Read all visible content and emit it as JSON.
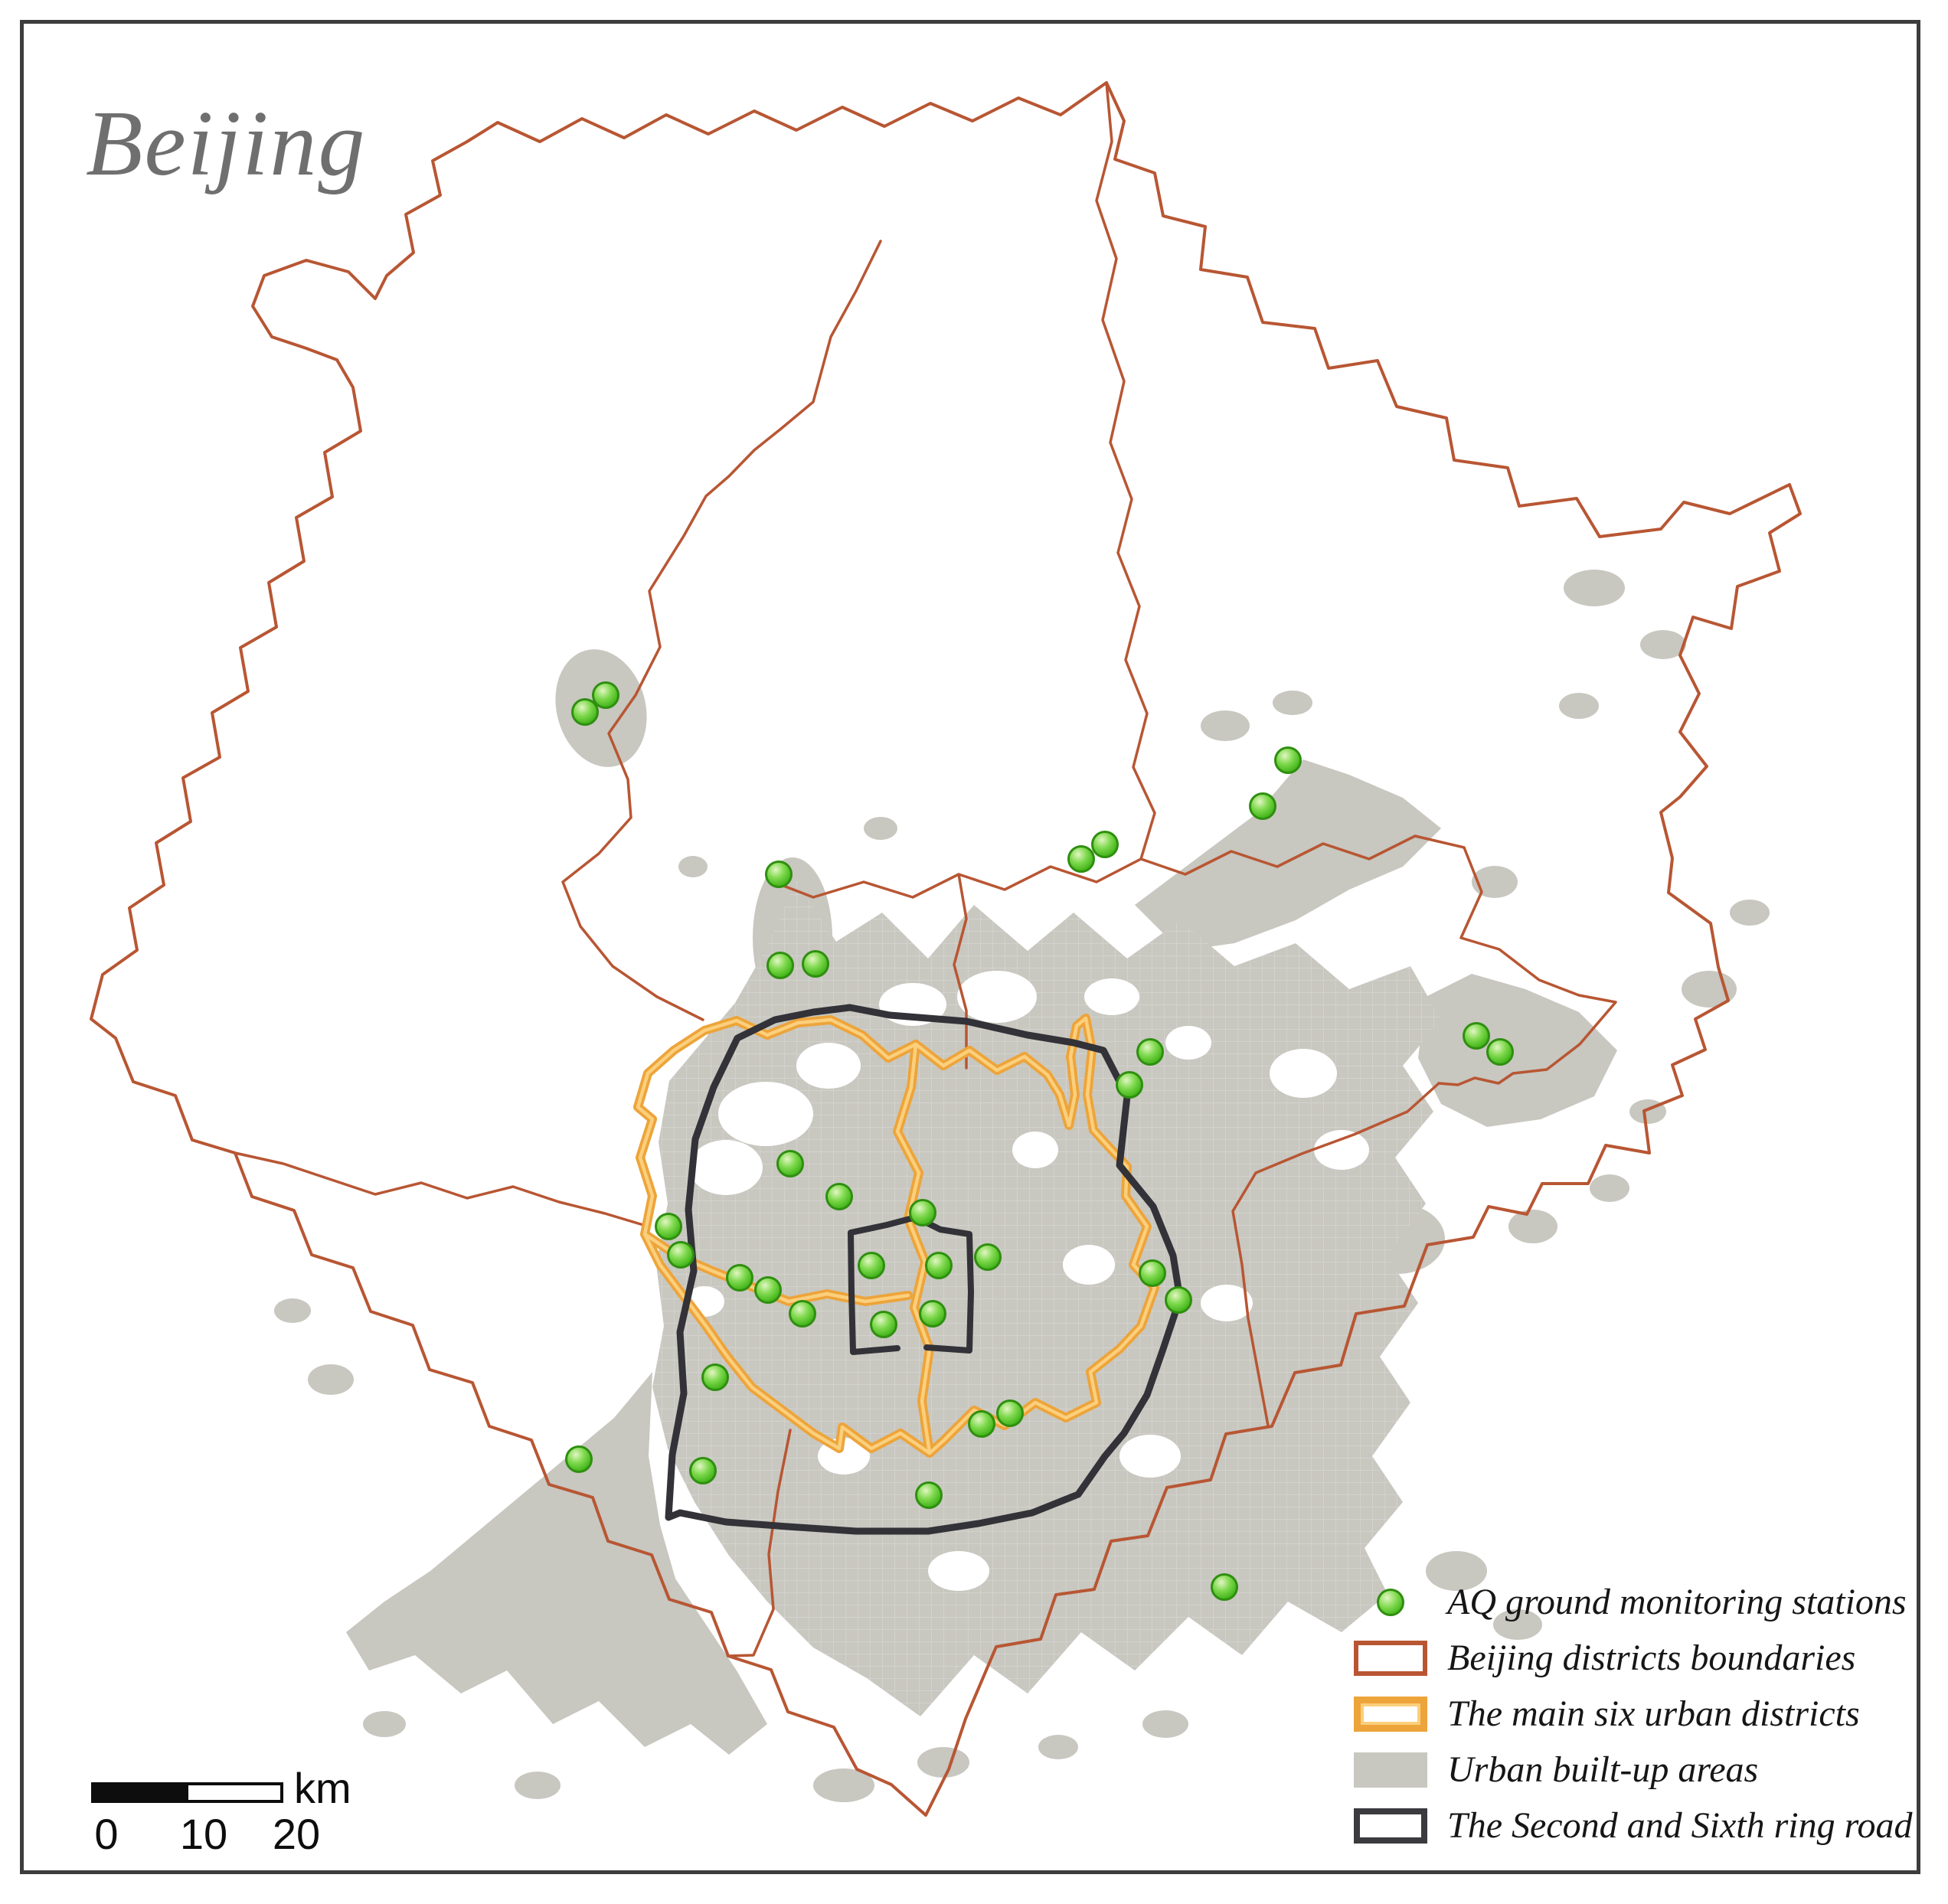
{
  "title": "Beijing",
  "map": {
    "region_label": "Beijing",
    "colors": {
      "station_fill": "#52c51f",
      "station_edge": "#2f8f10",
      "district_boundary": "#b85633",
      "six_districts_outer": "#eda43a",
      "six_districts_inner": "#fbcf7c",
      "built_up_fill": "#c8c7c0",
      "ring_road": "#323238",
      "frame": "#3d3d3d",
      "title_gray": "#6f6f6f"
    },
    "stations": [
      [
        764,
        930
      ],
      [
        791,
        908
      ],
      [
        1017,
        1142
      ],
      [
        1019,
        1261
      ],
      [
        1065,
        1259
      ],
      [
        1412,
        1122
      ],
      [
        1443,
        1103
      ],
      [
        1682,
        993
      ],
      [
        1649,
        1053
      ],
      [
        1502,
        1374
      ],
      [
        1475,
        1417
      ],
      [
        1928,
        1353
      ],
      [
        1959,
        1374
      ],
      [
        1032,
        1520
      ],
      [
        1096,
        1563
      ],
      [
        1205,
        1584
      ],
      [
        873,
        1602
      ],
      [
        889,
        1639
      ],
      [
        966,
        1669
      ],
      [
        1003,
        1685
      ],
      [
        1048,
        1716
      ],
      [
        1138,
        1653
      ],
      [
        1226,
        1653
      ],
      [
        1290,
        1642
      ],
      [
        1154,
        1730
      ],
      [
        1218,
        1716
      ],
      [
        934,
        1799
      ],
      [
        918,
        1921
      ],
      [
        756,
        1906
      ],
      [
        1282,
        1860
      ],
      [
        1319,
        1846
      ],
      [
        1505,
        1663
      ],
      [
        1539,
        1698
      ],
      [
        1213,
        1953
      ],
      [
        1599,
        2073
      ]
    ],
    "station_count": 35
  },
  "legend": {
    "items": [
      {
        "label": "AQ ground monitoring stations",
        "type": "dot",
        "color": "#52c51f"
      },
      {
        "label": "Beijing districts boundaries",
        "type": "outline",
        "color": "#b85633"
      },
      {
        "label": "The main six urban districts",
        "type": "outline-thick",
        "color": "#eda43a"
      },
      {
        "label": "Urban built-up areas",
        "type": "fill",
        "color": "#c8c7c0"
      },
      {
        "label": "The Second and Sixth ring road",
        "type": "outline-dark",
        "color": "#3a3a3f"
      }
    ]
  },
  "scale_bar": {
    "ticks": [
      "0",
      "10",
      "20"
    ],
    "unit": "km"
  }
}
